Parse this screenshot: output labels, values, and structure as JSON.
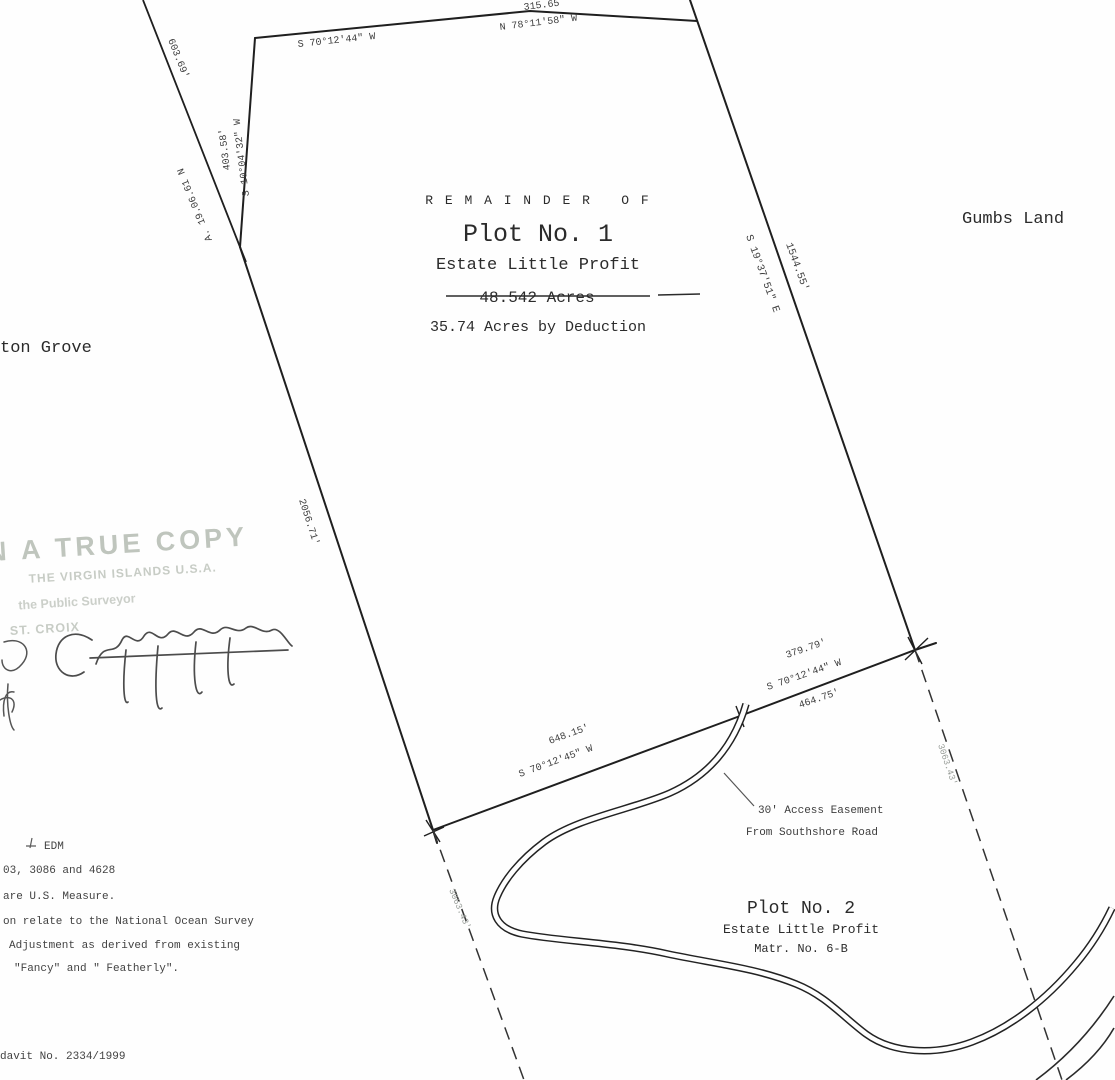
{
  "page": {
    "background": "#fefefe",
    "ink": "#1f1f1f"
  },
  "title_block": {
    "remainder_of": "R E M A I N D E R   O F",
    "plot_name": "Plot No. 1",
    "estate_name": "Estate Little Profit",
    "struck_acreage": "48.542 Acres",
    "revised_acreage": "35.74 Acres by Deduction"
  },
  "adjoiners": {
    "right": "Gumbs Land",
    "left_partial": "ton Grove"
  },
  "plot2_block": {
    "plot_name": "Plot No. 2",
    "estate_name": "Estate Little Profit",
    "matr_no": "Matr. No. 6-B"
  },
  "easement_note": {
    "line1": "30' Access Easement",
    "line2": "From Southshore Road"
  },
  "boundary_labels": {
    "top_seg1_bearing": "S 70°12'44\" W",
    "top_seg2_distance": "315.65",
    "top_seg2_bearing": "N 78°11'58\" W",
    "east_bearing": "S 19°37'51\" E",
    "east_distance": "1544.55'",
    "nw_distance": "403.58'",
    "nw_bearing": "S 10°04'32\" W",
    "west_distance": "2056.71'",
    "adjoiner_distance": "603.69'",
    "adjoiner_note": "A. 19.06.61 N",
    "se_distance_above": "379.79'",
    "se_bearing": "S 70°12'44\" W",
    "se_distance_below": "464.75'",
    "sw_distance": "648.15'",
    "sw_bearing": "S 70°12'45\" W",
    "dashed_east_distance": "3063.43'",
    "dashed_west_distance": "3063.43'"
  },
  "stamp": {
    "line1": "N A TRUE COPY",
    "line2": "THE VIRGIN ISLANDS U.S.A.",
    "line3": "the Public Surveyor",
    "line4": "ST. CROIX"
  },
  "notes": {
    "line1": "EDM",
    "line2": "03, 3086 and 4628",
    "line3": "are U.S. Measure.",
    "line4": "on relate to the National Ocean Survey",
    "line5": "Adjustment as derived from existing",
    "line6": "\"Fancy\" and \" Featherly\".",
    "docket": "davit No. 2334/1999"
  }
}
